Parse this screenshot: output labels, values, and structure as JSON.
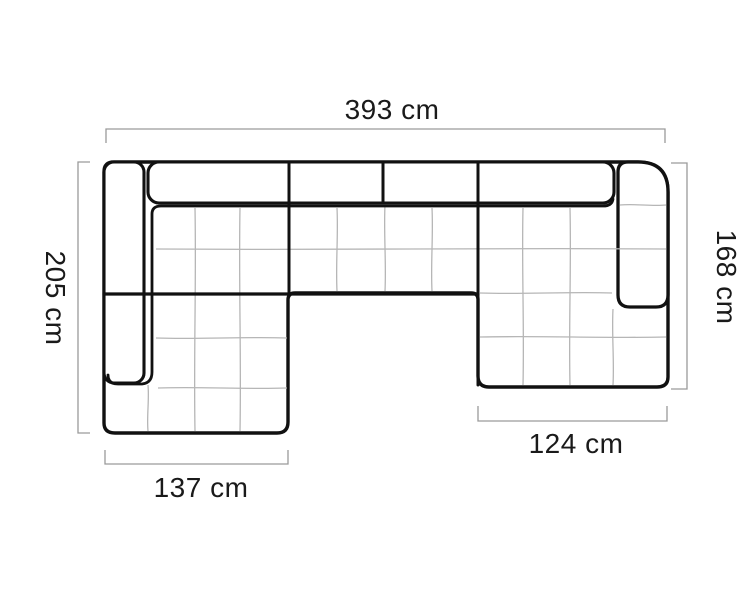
{
  "diagram": {
    "name": "sofa-top-view-dimension-drawing",
    "subject": "u-shaped-sectional-sofa",
    "unit": "cm",
    "labels": {
      "width_total": "393 cm",
      "depth_left": "205 cm",
      "depth_right": "168 cm",
      "chaise_left_width": "137 cm",
      "chaise_right_width": "124 cm"
    },
    "values": {
      "width_total": 393,
      "depth_left": 205,
      "depth_right": 168,
      "chaise_left_width": 137,
      "chaise_right_width": 124
    },
    "colors": {
      "outline": "#111111",
      "dimension_line": "#9a9a9a",
      "quilt_line": "#b6b6b6",
      "label_text": "#1a1a1a",
      "background": "#ffffff"
    }
  }
}
